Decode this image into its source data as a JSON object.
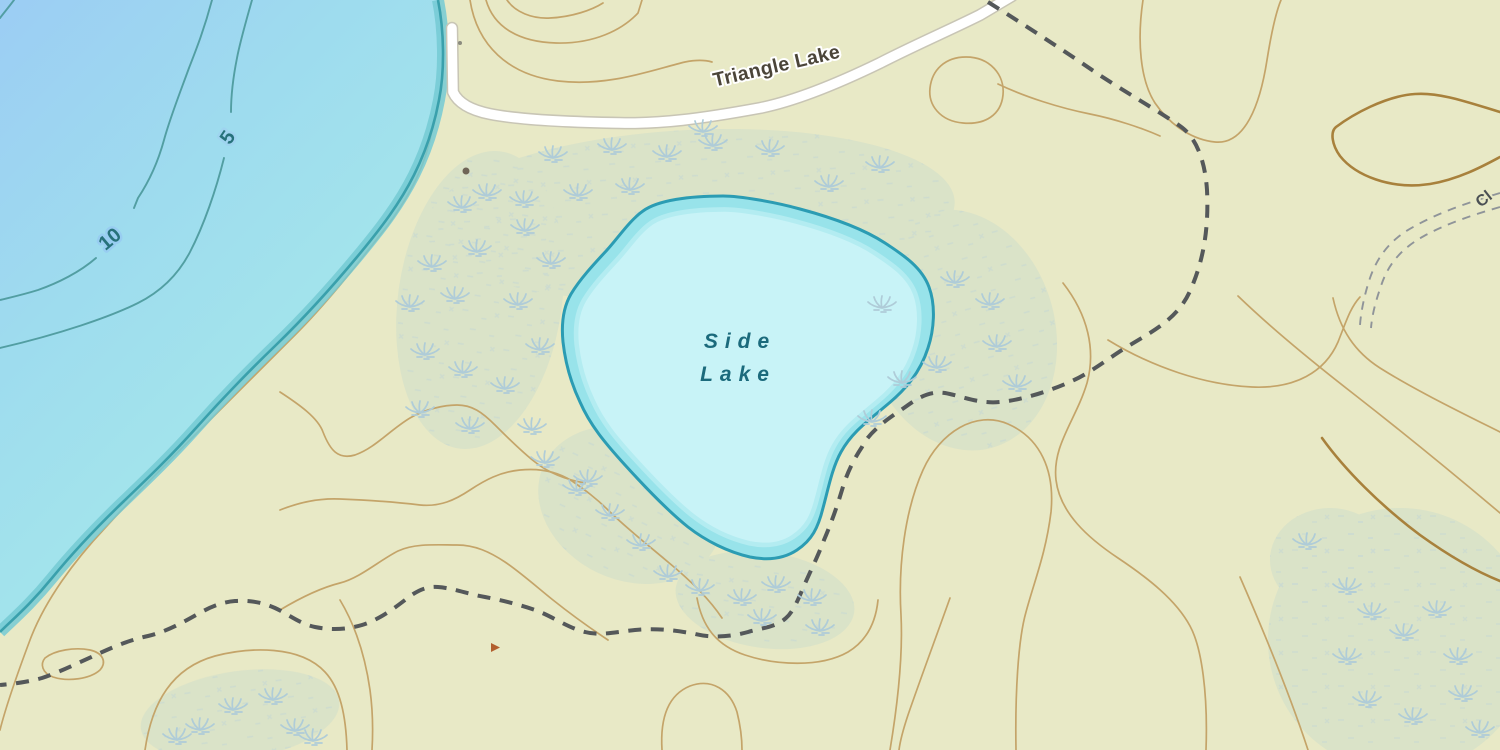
{
  "map": {
    "type": "topographic-map-view",
    "labels": {
      "side_lake_line1": "Side",
      "side_lake_line2": "Lake",
      "road_name": "Triangle Lake",
      "partial_road_name": "Cl",
      "depth_5": "5",
      "depth_10": "10"
    },
    "features": {
      "big_lake": "large lake with depth contours (west)",
      "side_lake": "Side Lake pond (center)",
      "road": "Triangle Lake road (white, gray casing)",
      "trail": "dashed foot trail",
      "double_track": "double-dashed 4WD track (east edge)",
      "marsh": "wetland with grass-tuft symbols",
      "contours": "tan elevation contour lines",
      "point_marker": "small dark dot north-west of Side Lake",
      "triangle_marker": "small red-brown triangle marker south-west"
    },
    "colors": {
      "land": "#e8e9c6",
      "water_deep": "#9ccdf4",
      "water_mid": "#9edcee",
      "water_shallow": "#a6e9ea",
      "shore_band": "#74cad3",
      "shore_edge": "#3aa0ac",
      "pond_fill": "#c8f3f7",
      "pond_band": "#98e3ea",
      "pond_border": "#2b9cb3",
      "contour": "#c4a469",
      "index_contour": "#a8813c",
      "bathy_contour": "#4e9b9e",
      "trail": "#54585a",
      "road_fill": "#ffffff",
      "road_casing": "#c8c5b5",
      "water_label": "#1b6a7c",
      "road_label": "#4b4539",
      "depth_label": "#27727b",
      "marsh_symbol": "#afccd8"
    }
  }
}
